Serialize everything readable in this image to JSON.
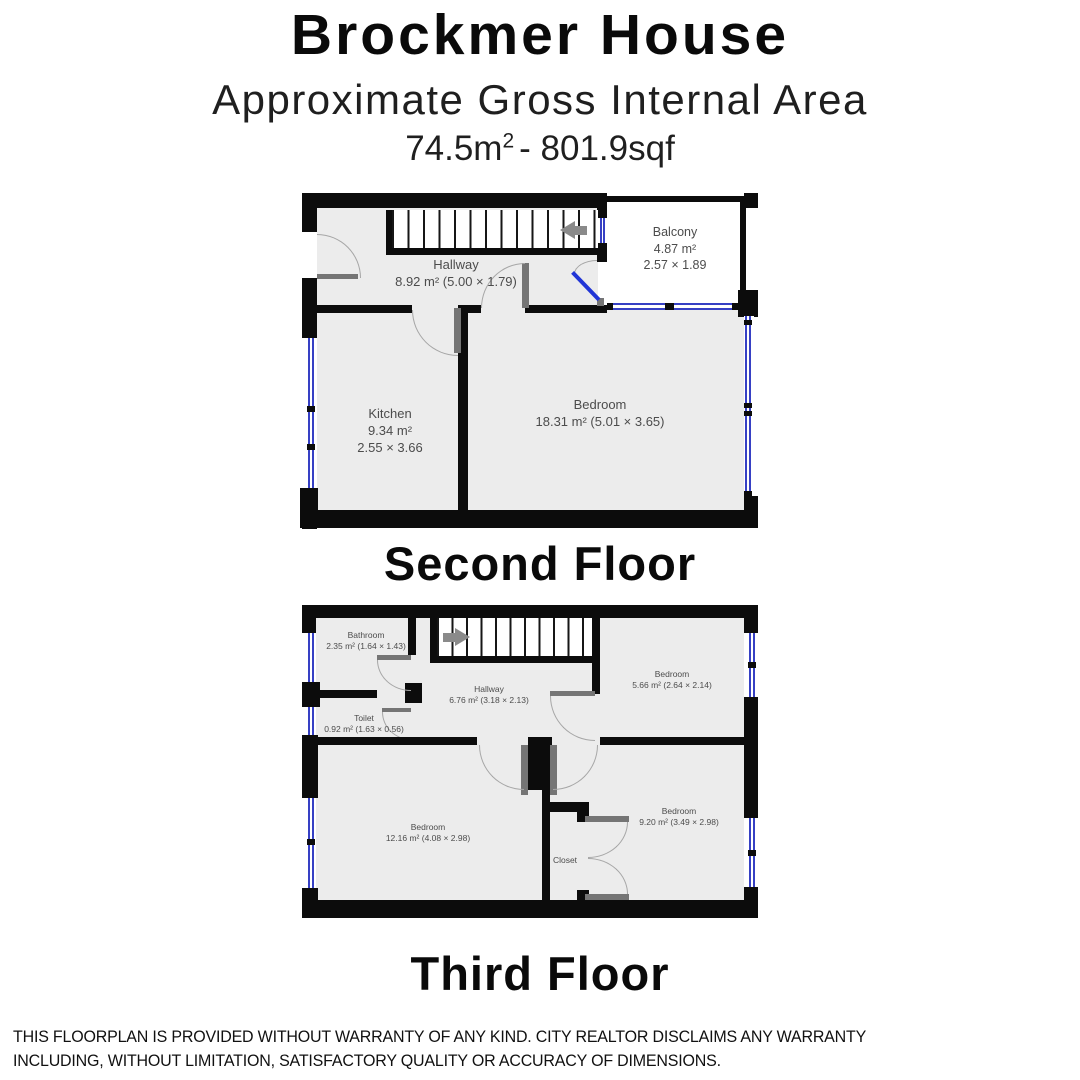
{
  "header": {
    "title": "Brockmer House",
    "subtitle": "Approximate Gross Internal Area",
    "area_prefix": "74.5m",
    "area_sup": "2",
    "area_suffix": "- 801.9sqf"
  },
  "floors": [
    {
      "name": "Second Floor",
      "rooms": [
        {
          "name": "Hallway",
          "dims": "8.92 m² (5.00 × 1.79)"
        },
        {
          "name": "Balcony",
          "area": "4.87 m²",
          "dims": "2.57 × 1.89"
        },
        {
          "name": "Kitchen",
          "area": "9.34 m²",
          "dims": "2.55 × 3.66"
        },
        {
          "name": "Bedroom",
          "dims": "18.31 m² (5.01 × 3.65)"
        }
      ]
    },
    {
      "name": "Third Floor",
      "rooms": [
        {
          "name": "Bathroom",
          "dims": "2.35 m² (1.64 × 1.43)"
        },
        {
          "name": "Hallway",
          "dims": "6.76 m² (3.18 × 2.13)"
        },
        {
          "name": "Toilet",
          "dims": "0.92 m² (1.63 × 0.56)"
        },
        {
          "name": "Bedroom",
          "dims": "5.66 m² (2.64 × 2.14)"
        },
        {
          "name": "Bedroom",
          "dims": "12.16 m² (4.08 × 2.98)"
        },
        {
          "name": "Bedroom",
          "dims": "9.20 m² (3.49 × 2.98)"
        },
        {
          "name": "Closet"
        }
      ]
    }
  ],
  "footer": {
    "disclaimer_line1": "THIS FLOORPLAN IS PROVIDED WITHOUT WARRANTY OF ANY KIND. CITY REALTOR DISCLAIMS ANY WARRANTY",
    "disclaimer_line2": "INCLUDING, WITHOUT LIMITATION, SATISFACTORY QUALITY OR ACCURACY OF DIMENSIONS."
  },
  "colors": {
    "wall": "#0c0c0c",
    "floor": "#ececec",
    "window_blue": "#3640c4",
    "door_gray": "#757575",
    "arc_gray": "#a6a6a6",
    "label_gray": "#4c4c4c"
  }
}
